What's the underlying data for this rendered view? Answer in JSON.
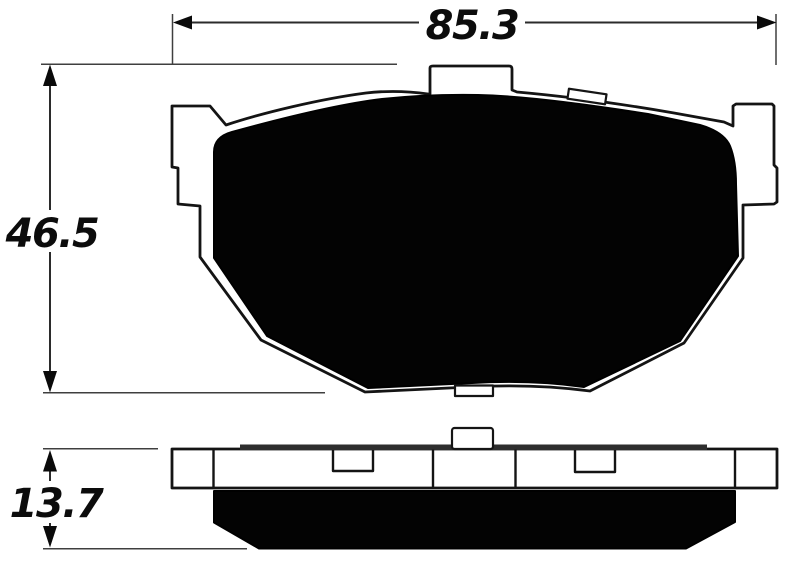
{
  "diagram": {
    "dimension_labels": {
      "width": "85.3",
      "height": "46.5",
      "thickness": "13.7"
    },
    "colors": {
      "line": "#141414",
      "friction_fill": "#030303",
      "plate_fill": "#ffffff",
      "dimension_line": "#3f3f3f",
      "background": "#ffffff"
    }
  }
}
